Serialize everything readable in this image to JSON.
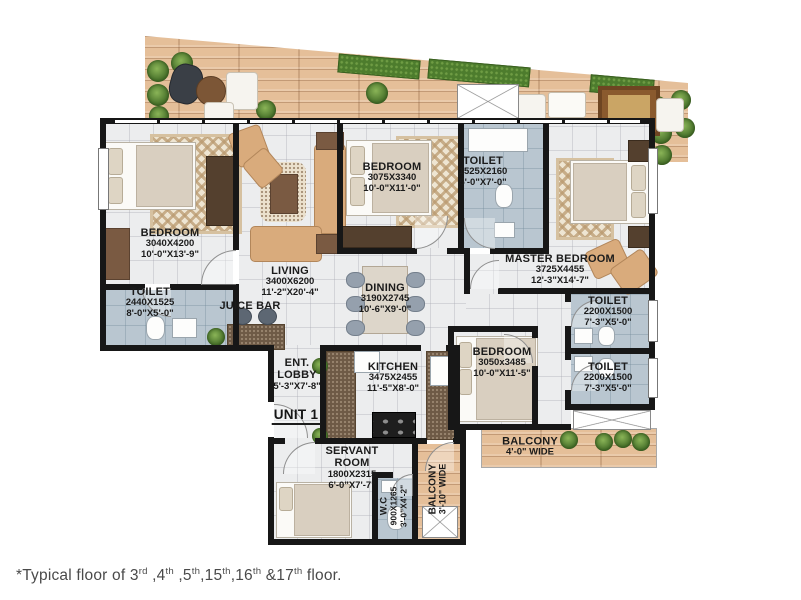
{
  "unit_label": "UNIT 1",
  "rooms": {
    "bedroom_left": {
      "name": "BEDROOM",
      "metric": "3040X4200",
      "imperial": "10'-0\"X13'-9\""
    },
    "toilet_left": {
      "name": "TOILET",
      "metric": "2440X1525",
      "imperial": "8'-0\"X5'-0\""
    },
    "living": {
      "name": "LIVING",
      "metric": "3400X6200",
      "imperial": "11'-2\"X20'-4\""
    },
    "juice_bar": {
      "name": "JUICE BAR"
    },
    "bedroom_top": {
      "name": "BEDROOM",
      "metric": "3075X3340",
      "imperial": "10'-0\"X11'-0\""
    },
    "toilet_top": {
      "name": "TOILET",
      "metric": "1525X2160",
      "imperial": "5'-0\"X7'-0\""
    },
    "master_bedroom": {
      "name": "MASTER BEDROOM",
      "metric": "3725X4455",
      "imperial": "12'-3\"X14'-7\""
    },
    "dining": {
      "name": "DINING",
      "metric": "3190X2745",
      "imperial": "10'-6\"X9'-0\""
    },
    "toilet_right_upper": {
      "name": "TOILET",
      "metric": "2200X1500",
      "imperial": "7'-3\"X5'-0\""
    },
    "toilet_right_lower": {
      "name": "TOILET",
      "metric": "2200X1500",
      "imperial": "7'-3\"X5'-0\""
    },
    "bedroom_right": {
      "name": "BEDROOM",
      "metric": "3050x3485",
      "imperial": "10'-0\"X11'-5\""
    },
    "balcony_right": {
      "name": "BALCONY",
      "width_label": "4'-0\" WIDE"
    },
    "kitchen": {
      "name": "KITCHEN",
      "metric": "3475X2455",
      "imperial": "11'-5\"X8'-0\""
    },
    "ent_lobby": {
      "name": "ENT. LOBBY",
      "imperial": "5'-3\"X7'-8\""
    },
    "servant_room": {
      "name": "SERVANT ROOM",
      "metric": "1800X2315",
      "imperial": "6'-0\"X7'-7\""
    },
    "wc": {
      "name": "W.C",
      "metric": "900X1265",
      "imperial": "3'-0\"X4'-2\""
    },
    "balcony_bottom": {
      "name": "BALCONY",
      "width_label": "3'-10\" WIDE"
    }
  },
  "footnote": {
    "segments": [
      {
        "t": "*Typical floor of 3"
      },
      {
        "t": "rd",
        "sup": true
      },
      {
        "t": " ,4"
      },
      {
        "t": "th",
        "sup": true
      },
      {
        "t": " ,5"
      },
      {
        "t": "th",
        "sup": true
      },
      {
        "t": ",15"
      },
      {
        "t": "th",
        "sup": true
      },
      {
        "t": ",16"
      },
      {
        "t": "th",
        "sup": true
      },
      {
        "t": " &17"
      },
      {
        "t": "th",
        "sup": true
      },
      {
        "t": " floor."
      }
    ]
  },
  "colors": {
    "wall": "#171717",
    "tile_floor": "#ecedee",
    "toilet_floor": "#b9c6d0",
    "wood": "#e5bf99",
    "kitchen_counter": "#6e5a46",
    "furniture_tan": "#d9ab7c",
    "wardrobe_brown": "#54402e",
    "plant_green": "#47702a"
  }
}
